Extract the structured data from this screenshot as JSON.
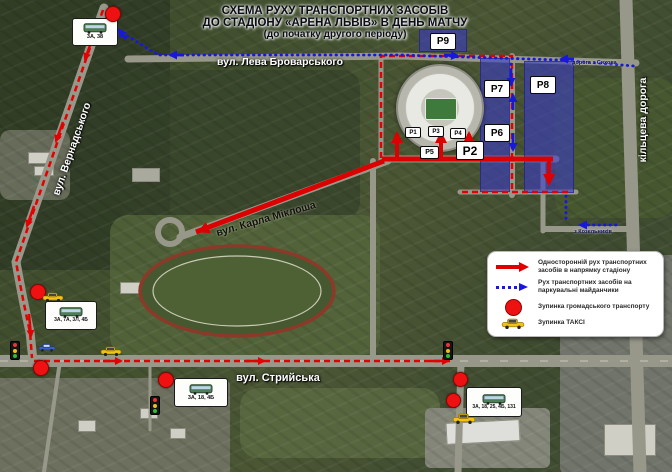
{
  "title": {
    "line1": "СХЕМА РУХУ ТРАНСПОРТНИХ ЗАСОБІВ",
    "line2": "ДО СТАДІОНУ «АРЕНА ЛЬВІВ» В ДЕНЬ МАТЧУ",
    "line3": "(до початку другого періоду)"
  },
  "streets": {
    "brovarskoho": "вул. Лева Броварського",
    "vernadskoho": "вул. Вернадського",
    "miklosha": "вул. Карла Міклоша",
    "stryiska": "вул. Стрийська",
    "kiltseva": "кільцева дорога"
  },
  "annotations": {
    "road_from_ring": "дорога з Сихова",
    "road_from_kozelnyky": "з Козельників"
  },
  "parking": {
    "p1": "P1",
    "p2": "P2",
    "p3": "P3",
    "p4": "P4",
    "p5": "P5",
    "p6": "P6",
    "p7": "P7",
    "p8": "P8",
    "p9": "P9"
  },
  "bus_stops": [
    {
      "routes": "3А, 38"
    },
    {
      "routes": "3А, 7А, 3Л, 4Б"
    },
    {
      "routes": "3А, 18, 4Б"
    },
    {
      "routes": "3А, 18, 25, 4Б, 131"
    }
  ],
  "legend": {
    "one_way": "Односторонній рух транспортних засобів в напрямку стадіону",
    "to_parking": "Рух транспортних засобів на паркувальні майданчики",
    "public_stop": "Зупинка громадського транспорту",
    "taxi_stop": "Зупинка ТАКСІ"
  },
  "colors": {
    "route_to_stadium": "#e10000",
    "route_to_parking": "#1818dc",
    "parking_zone": "#3a3aca",
    "stop_marker": "#ee1111",
    "taxi": "#f0c21a"
  }
}
